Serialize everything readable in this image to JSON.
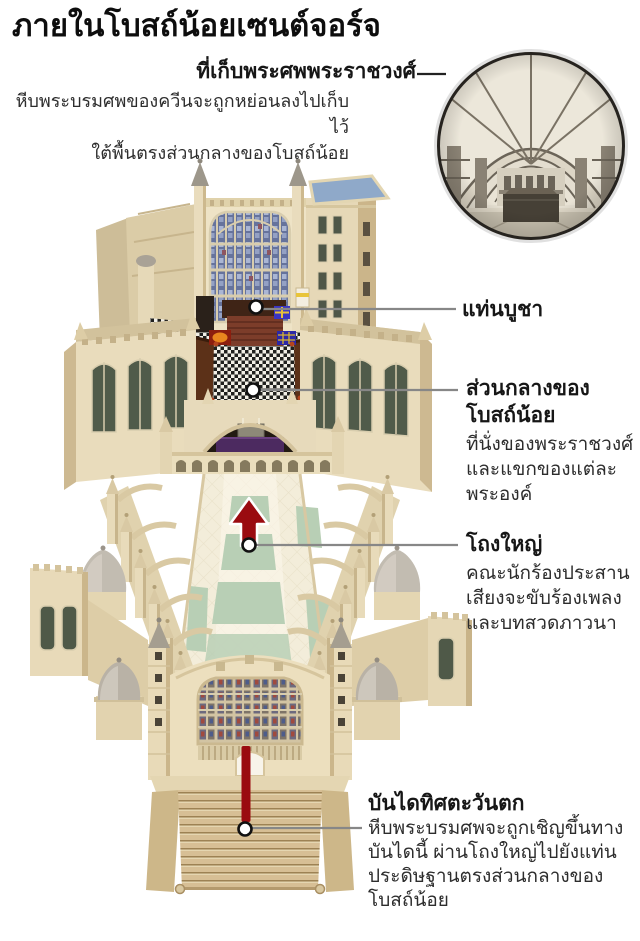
{
  "title": "ภายในโบสถ์น้อยเซนต์จอร์จ",
  "callouts": {
    "royal_vault": {
      "label": "ที่เก็บพระศพพระราชวงศ์",
      "desc": [
        "หีบพระบรมศพของควีนจะถูกหย่อนลงไปเก็บไว้",
        "ใต้พื้นตรงส่วนกลางของโบสถ์น้อย"
      ]
    },
    "altar": {
      "label": "แท่นบูชา"
    },
    "quire": {
      "label": [
        "ส่วนกลางของ",
        "โบสถ์น้อย"
      ],
      "desc": [
        "ที่นั่งของพระราชวงศ์",
        "และแขกของแต่ละ",
        "พระองค์"
      ]
    },
    "nave": {
      "label": "โถงใหญ่",
      "desc": [
        "คณะนักร้องประสาน",
        "เสียงจะขับร้องเพลง",
        "และบทสวดภาวนา"
      ]
    },
    "west_steps": {
      "label": "บันไดทิศตะวันตก",
      "desc": [
        "หีบพระบรมศพจะถูกเชิญขึ้นทาง",
        "บันไดนี้ ผ่านโถงใหญ่ไปยังแท่น",
        "ประดิษฐานตรงส่วนกลางของ",
        "โบสถ์น้อย"
      ]
    }
  },
  "colors": {
    "accent_red": "#9a0b10",
    "callout_line": "#878787",
    "stone_light": "#eee3c6",
    "stone_dark": "#cdb992",
    "roof_blue": "#8fa9c9",
    "floor_green": "#b8cfb5",
    "glass_green": "#4f5948"
  }
}
